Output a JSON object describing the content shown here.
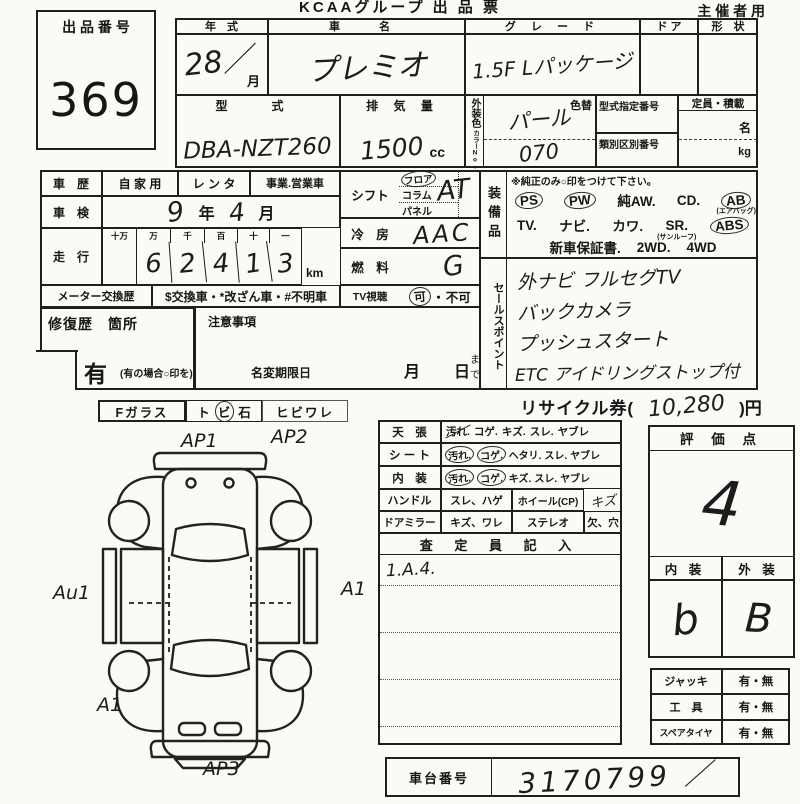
{
  "header": {
    "brand": "KCAAグループ 出 品 票",
    "usage": "主 催 者 用"
  },
  "lot": {
    "label": "出 品 番 号",
    "number": "369"
  },
  "top": {
    "year_label": "年　式",
    "year_value": "28／",
    "month": "月",
    "name_label": "車　名",
    "name_value": "プレミオ",
    "grade_label": "グ レ ー ド",
    "grade_value": "1.5F Lパッケージ",
    "door_label": "ド ア",
    "shape_label": "形　状",
    "model_label": "型　式",
    "model_value": "DBA-NZT260",
    "disp_label": "排 気 量",
    "disp_value": "1500",
    "disp_unit": "cc",
    "color_label": "外装色",
    "color_no_label": "カラーNo.",
    "color_change": "色替",
    "color_value": "パール",
    "color_no_value": "070",
    "type_no_label": "型式指定番号",
    "class_no_label": "類別区別番号",
    "capacity_label": "定員・積載",
    "persons": "名",
    "weight": "kg"
  },
  "history": {
    "label": "車　歴",
    "opt1": "自 家 用",
    "opt2": "レ ン タ",
    "opt3": "事業.営業車",
    "shaken_label": "車　検",
    "shaken_year": "9",
    "shaken_year_unit": "年",
    "shaken_month": "4",
    "shaken_month_unit": "月",
    "mileage_label": "走　行",
    "digit_headers": [
      "十万",
      "万",
      "千",
      "百",
      "十",
      "一"
    ],
    "digits": [
      "",
      "6",
      "2",
      "4",
      "1",
      "3"
    ],
    "unit": "km",
    "meter_label": "メーター交換歴",
    "meter_text": "$交換車・*改ざん車・#不明車"
  },
  "controls": {
    "shift_label": "シフト",
    "shift_opt1": "フロア",
    "shift_opt2": "コラム",
    "shift_opt3": "パネル",
    "shift_value": "AT",
    "ac_label": "冷　房",
    "ac_value": "AAC",
    "fuel_label": "燃　料",
    "fuel_value": "G",
    "tv_label": "TV視聴",
    "tv_ok": "可",
    "tv_dot": "・",
    "tv_ng": "不可"
  },
  "equipment": {
    "label": "装備品",
    "note": "※純正のみ○印をつけて下さい。",
    "l1": [
      "PS",
      "PW",
      "純AW.",
      "CD.",
      "AB"
    ],
    "ab_note": "(エアバッグ)",
    "l2": [
      "TV.",
      "ナビ.",
      "カワ.",
      "SR.",
      "ABS"
    ],
    "sr_note": "(サンルーフ)",
    "l3a": "新車保証書.",
    "l3b": "2WD.",
    "l3c": "4WD"
  },
  "sales": {
    "label": "セールスポイント",
    "lines": [
      "外ナビ フルセグTV",
      "バックカメラ",
      "プッシュスタート",
      "ETC アイドリングストップ付"
    ]
  },
  "repair": {
    "label": "修復歴　箇所",
    "yes": "有",
    "yes_note": "(有の場合○印を)"
  },
  "caution": {
    "label": "注意事項",
    "deadline": "名変期限日",
    "month": "月",
    "day": "日",
    "made": "まで"
  },
  "glass": {
    "label": "Fガラス",
    "chip_a": "ト",
    "chip_b": "ビ",
    "chip_c": "石",
    "crack": "ヒビワレ"
  },
  "recycle": {
    "label": "リサイクル券(",
    "value": "10,280",
    "suffix": ")円"
  },
  "condition": {
    "rows": [
      {
        "label": "天　張",
        "tokens": [
          "汚れ.",
          "コゲ.",
          "キズ.",
          "スレ.",
          "ヤブレ"
        ]
      },
      {
        "label": "シ ー ト",
        "tokens": [
          "汚れ.",
          "コゲ.",
          "ヘタリ.",
          "スレ.",
          "ヤブレ"
        ]
      },
      {
        "label": "内　装",
        "tokens": [
          "汚れ.",
          "コゲ.",
          "キズ.",
          "スレ.",
          "ヤブレ"
        ]
      }
    ],
    "handle_label": "ハンドル",
    "handle_items": "スレ、ハゲ",
    "wheel_label": "ホイール(CP)",
    "wheel_value": "キズ",
    "mirror_label": "ドアミラー",
    "mirror_items": "キズ、ワレ",
    "stereo_label": "ステレオ",
    "stereo_items": "欠、穴",
    "inspector_label": "査 定 員 記 入",
    "inspector_note": "1.A.4."
  },
  "rating": {
    "label": "評 価 点",
    "score": "4",
    "interior_label": "内 装",
    "exterior_label": "外 装",
    "interior": "b",
    "exterior": "B"
  },
  "accessories": {
    "rows": [
      {
        "label": "ジャッキ",
        "value": "有・無"
      },
      {
        "label": "工　具",
        "value": "有・無"
      },
      {
        "label": "スペアタイヤ",
        "value": "有・無"
      }
    ]
  },
  "chassis": {
    "label": "車台番号",
    "value": "3170799 ／"
  },
  "diagram": {
    "marks": [
      "AP1",
      "AP2",
      "Au1",
      "A1",
      "A1",
      "AP3"
    ]
  }
}
